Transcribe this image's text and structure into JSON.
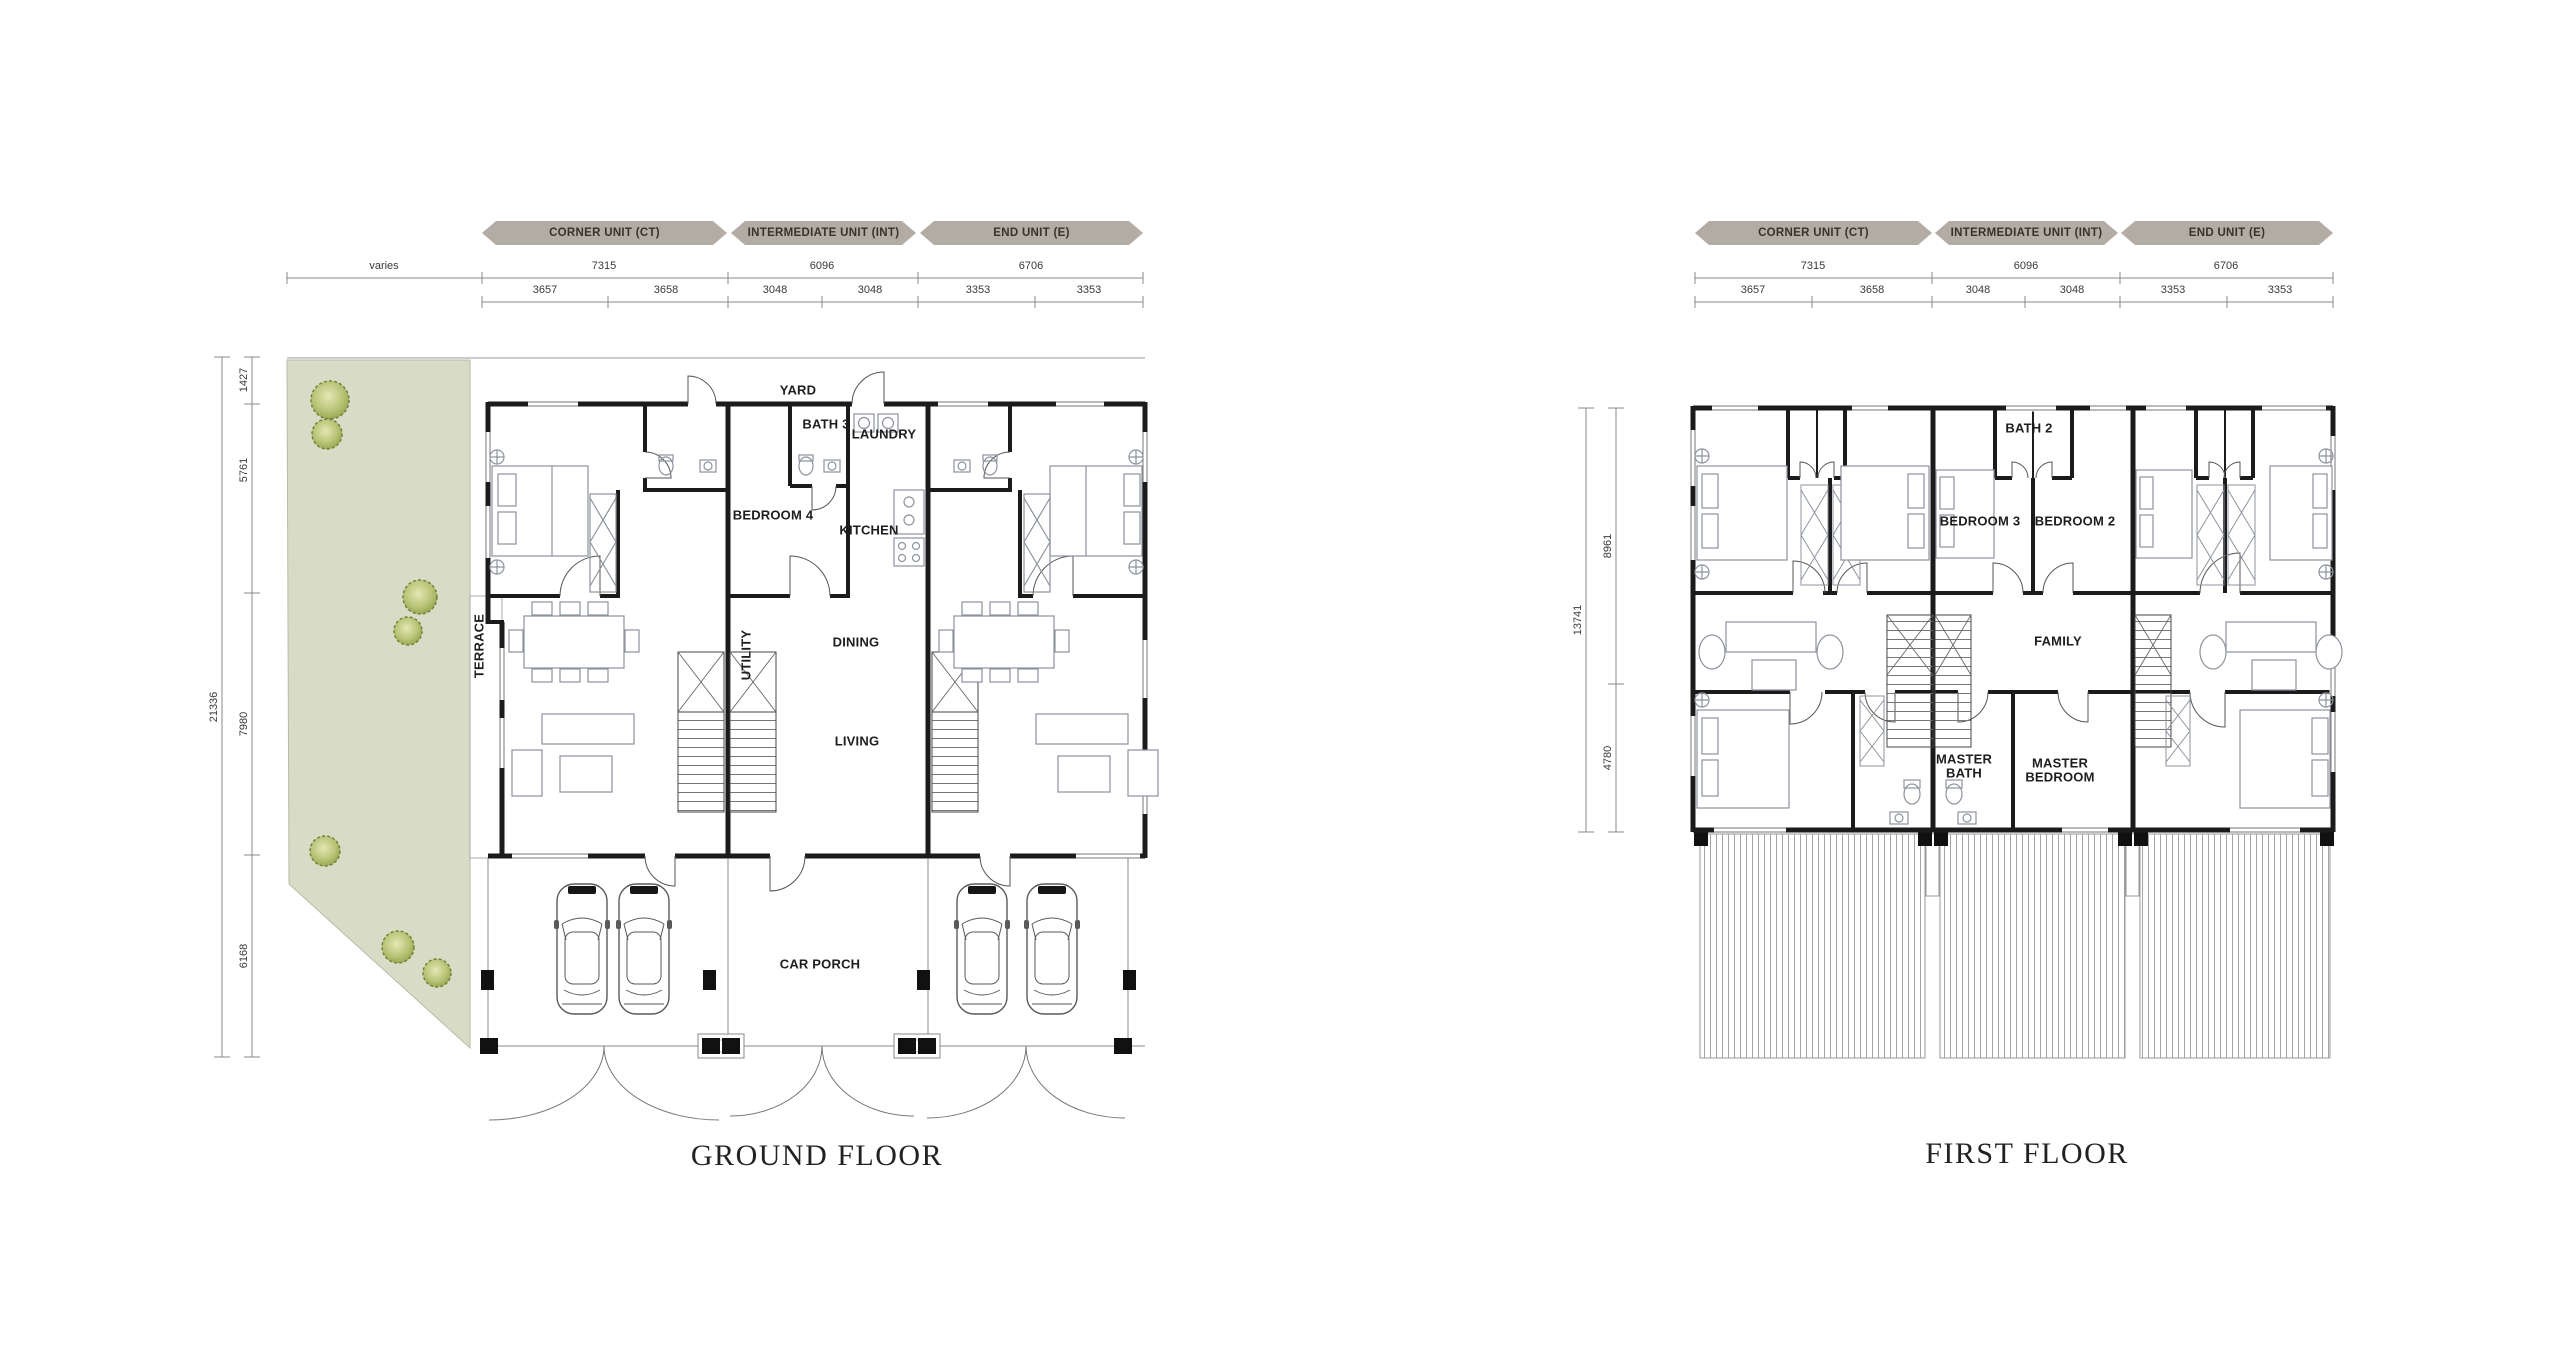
{
  "colors": {
    "background": "#ffffff",
    "banner": "#b3aca4",
    "banner_text": "#37322d",
    "wall": "#1b1b1b",
    "garden": "#d8dcc7",
    "tree": "#a9b468",
    "dim_text": "#3a3a3a"
  },
  "shared": {
    "banners": [
      {
        "label": "CORNER UNIT (CT)"
      },
      {
        "label": "INTERMEDIATE UNIT (INT)"
      },
      {
        "label": "END UNIT (E)"
      }
    ],
    "dims_top": [
      {
        "value": "7315"
      },
      {
        "value": "6096"
      },
      {
        "value": "6706"
      }
    ],
    "dims_sub": [
      {
        "value": "3657"
      },
      {
        "value": "3658"
      },
      {
        "value": "3048"
      },
      {
        "value": "3048"
      },
      {
        "value": "3353"
      },
      {
        "value": "3353"
      }
    ]
  },
  "ground_floor": {
    "title": "GROUND FLOOR",
    "varies_label": "varies",
    "overall_height": "21336",
    "left_dims": [
      {
        "value": "1427"
      },
      {
        "value": "5761"
      },
      {
        "value": "7980"
      },
      {
        "value": "6168"
      }
    ],
    "rooms": {
      "yard": "YARD",
      "bath3": "BATH 3",
      "laundry": "LAUNDRY",
      "bedroom4": "BEDROOM 4",
      "kitchen": "KITCHEN",
      "terrace": "TERRACE",
      "utility": "UTILITY",
      "dining": "DINING",
      "living": "LIVING",
      "car_porch": "CAR PORCH"
    }
  },
  "first_floor": {
    "title": "FIRST FLOOR",
    "overall_height": "13741",
    "left_dims": [
      {
        "value": "8961"
      },
      {
        "value": "4780"
      }
    ],
    "rooms": {
      "bath2": "BATH 2",
      "bedroom3": "BEDROOM 3",
      "bedroom2": "BEDROOM 2",
      "family": "FAMILY",
      "master_bath": "MASTER BATH",
      "master_bedroom": "MASTER BEDROOM"
    }
  }
}
